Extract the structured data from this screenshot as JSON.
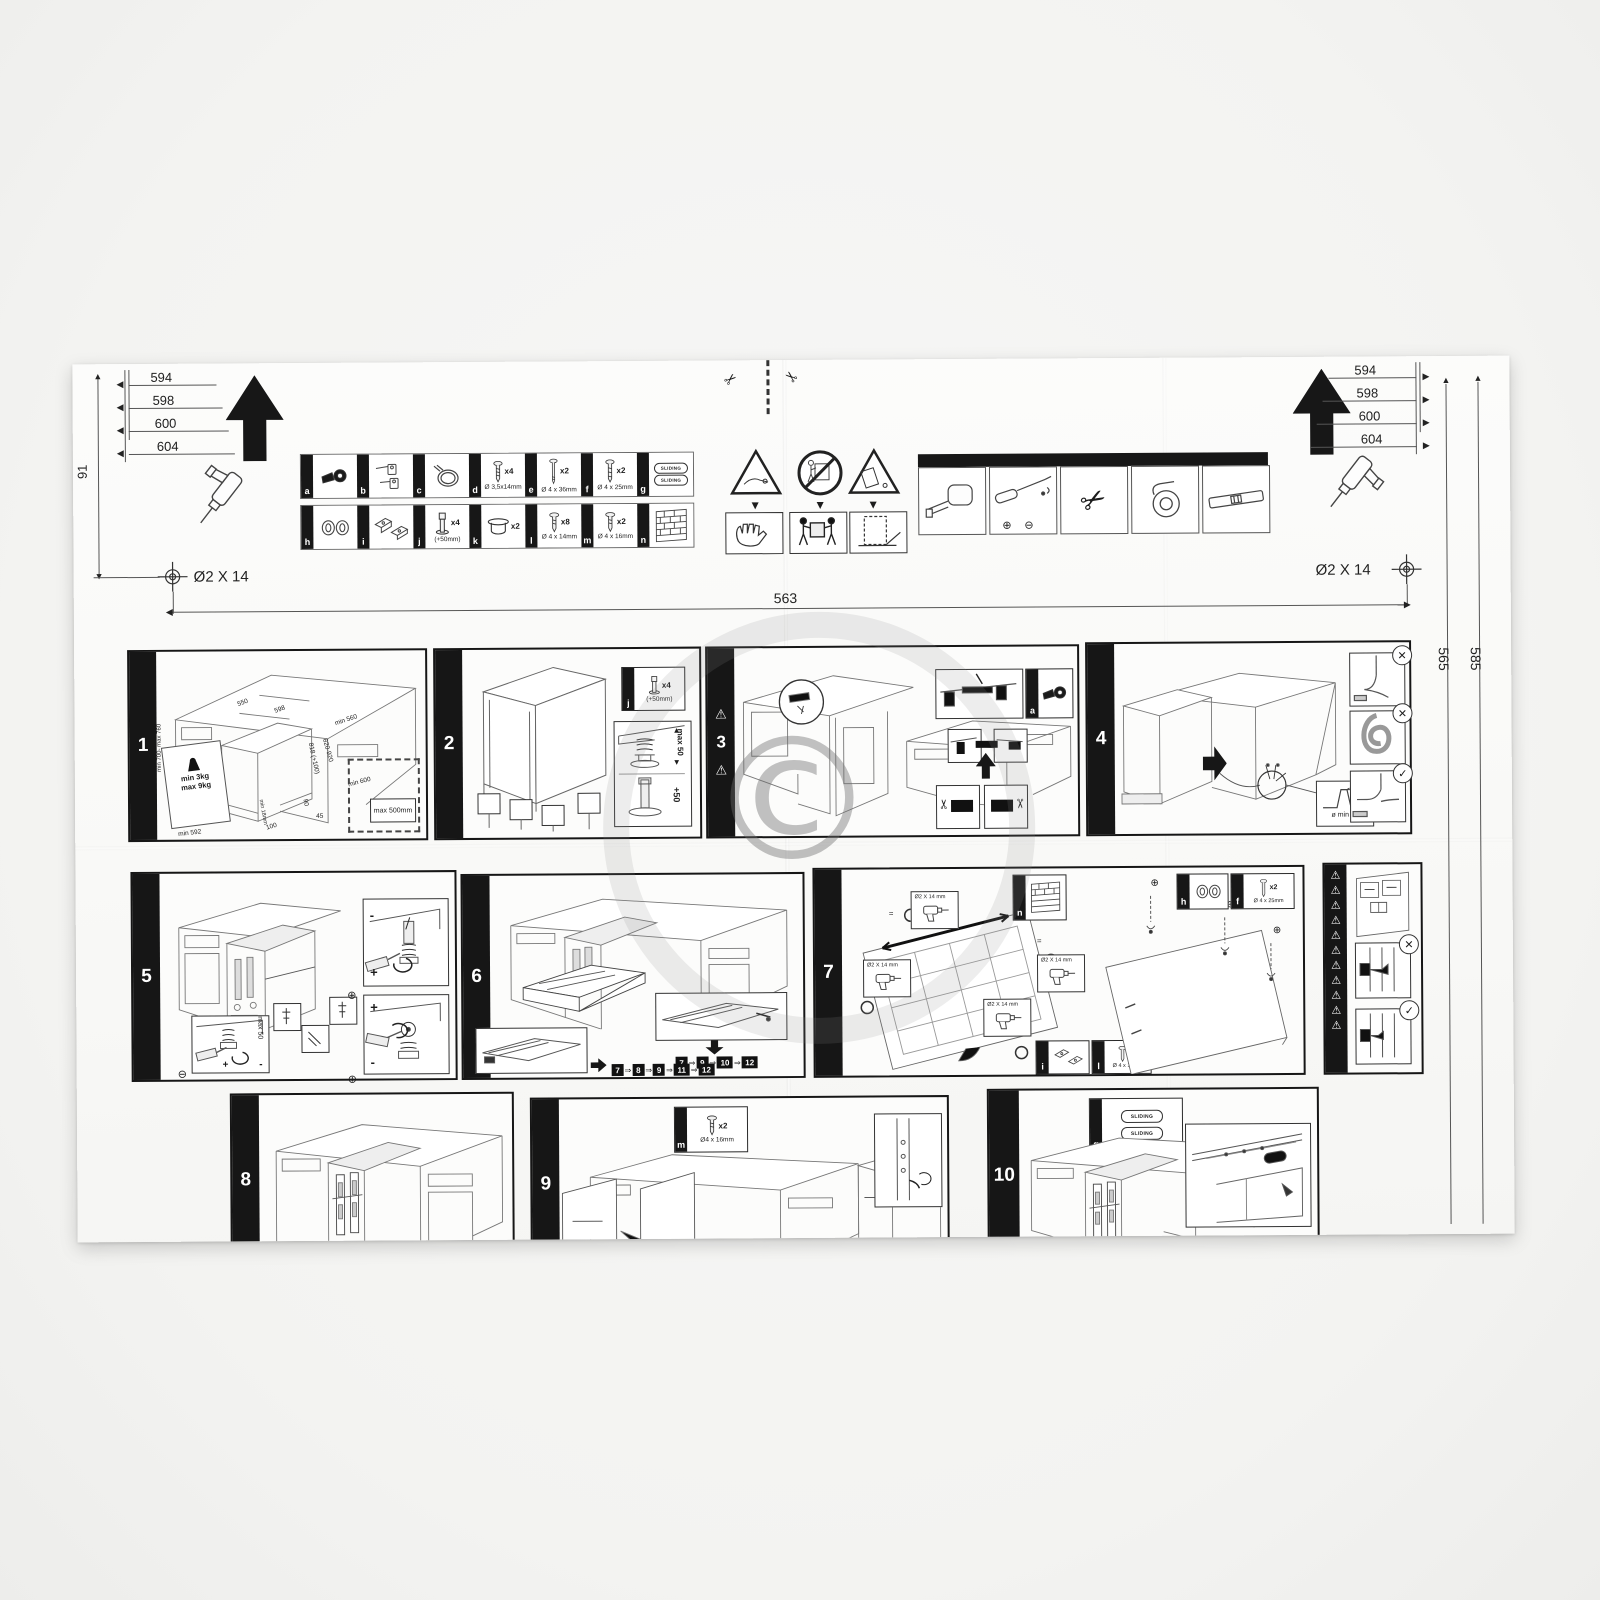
{
  "icons": {
    "warning": "⚠",
    "scissors": "✂",
    "cross": "✕",
    "check": "✓",
    "seq_arrow": "⇒",
    "circle_plus": "⊕",
    "circle_minus": "⊖",
    "arrow_up": "▲",
    "arrow_down": "▼",
    "arrow_left": "◀",
    "arrow_right": "▶"
  },
  "watermark": "©",
  "header": {
    "left": {
      "ticks": [
        "594",
        "598",
        "600",
        "604"
      ],
      "vertical_dim": "91",
      "drill_hole": "Ø2 X 14"
    },
    "right": {
      "ticks": [
        "594",
        "598",
        "600",
        "604"
      ],
      "drill_hole": "Ø2 X 14"
    },
    "span_dim": "563",
    "edge_dims": {
      "inner": "565",
      "outer": "585"
    }
  },
  "parts": {
    "row1": [
      {
        "id": "a"
      },
      {
        "id": "b"
      },
      {
        "id": "c"
      },
      {
        "id": "d",
        "qty": "x4",
        "size": "Ø 3,5x14mm"
      },
      {
        "id": "e",
        "qty": "x2",
        "size": "Ø 4 x 36mm"
      },
      {
        "id": "f",
        "qty": "x2",
        "size": "Ø 4 x 25mm"
      },
      {
        "id": "g",
        "plate": "SLIDING"
      }
    ],
    "row2": [
      {
        "id": "h"
      },
      {
        "id": "i"
      },
      {
        "id": "j",
        "qty": "x4",
        "size": "(+50mm)"
      },
      {
        "id": "k",
        "qty": "x2"
      },
      {
        "id": "l",
        "qty": "x8",
        "size": "Ø 4 x 14mm"
      },
      {
        "id": "m",
        "qty": "x2",
        "size": "Ø 4 x 16mm"
      },
      {
        "id": "n"
      }
    ]
  },
  "steps": {
    "s1": {
      "num": "1",
      "top_w1": "550",
      "top_w2": "598",
      "depth": "min 560",
      "niche_h": "820-920",
      "dw_h": "818 (+100)",
      "floor_d": "min 600",
      "panel_h": "min 700- max 760",
      "w_min": "min 3kg",
      "w_max": "max 9kg",
      "panel_w": "min 592",
      "plinth": "min 18mm",
      "d100": "100",
      "d45": "45",
      "d90": "90",
      "hose": "max 500mm"
    },
    "s2": {
      "num": "2",
      "part": "j",
      "qty": "x4",
      "size": "(+50mm)",
      "max": "max 50",
      "plus": "+50"
    },
    "s3": {
      "num": "3",
      "part": "a"
    },
    "s4": {
      "num": "4",
      "hole": "ø min 80"
    },
    "s5": {
      "num": "5",
      "max": "max 50",
      "plus": "+",
      "minus": "-"
    },
    "s6": {
      "num": "6",
      "seq1": [
        "7",
        "9",
        "10",
        "12"
      ],
      "seq2": [
        "7",
        "8",
        "9",
        "11",
        "12"
      ]
    },
    "s7": {
      "num": "7",
      "drill": "Ø2 X 14 mm",
      "eq": "=",
      "n": "n",
      "h": "h",
      "f": "f",
      "f_qty": "x2",
      "f_size": "Ø 4 x 25mm",
      "i": "i",
      "l": "l",
      "l_qty": "x8",
      "l_size": "Ø 4 x 14mm"
    },
    "s8": {
      "num": "8"
    },
    "s9": {
      "num": "9",
      "part": "m",
      "qty": "x2",
      "size": "Ø4 x 16mm"
    },
    "s10": {
      "num": "10",
      "part": "g",
      "plate": "SLIDING"
    }
  }
}
